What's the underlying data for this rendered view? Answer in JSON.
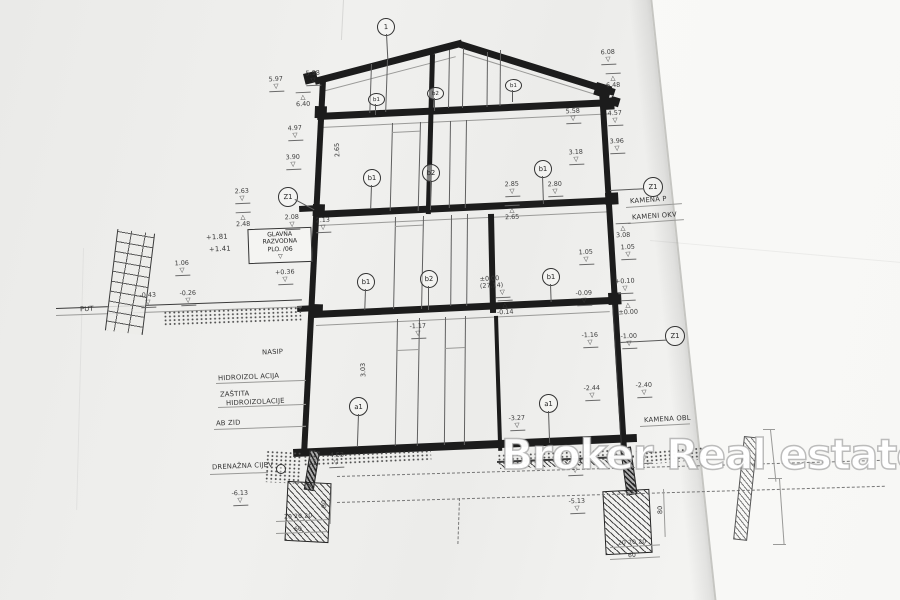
{
  "watermark": {
    "text": "Broker Real estate"
  },
  "markers": {
    "roof_detail": "1",
    "z1_left": "Z1",
    "z1_right": "Z1",
    "z1_lower_right": "Z1",
    "attic": [
      "b1",
      "b2",
      "b1"
    ],
    "level3": [
      "b1",
      "b2",
      "b1"
    ],
    "level2": [
      "b1",
      "b2",
      "b1"
    ],
    "level1": [
      "a1",
      "a1"
    ]
  },
  "labels": {
    "main_panel": {
      "l1": "GLAVNA",
      "l2": "RAZVODNA",
      "l3": "PLO. /06"
    },
    "put": "PUT",
    "nasip": "NASIP",
    "hidroizolacija": "HIDROIZOL ACIJA",
    "zastita_1": "ZAŠTITA",
    "zastita_2": "HIDROIZOLACIJE",
    "ab_zid": "AB ZID",
    "drenazna": "DRENAŽNA CIJEV",
    "kamena_ploca": "KAMENA  P",
    "kameni_okvir": "KAMENI  OKV",
    "kamena_obloga": "KAMENA OBL",
    "lvl_181": "+1.81",
    "lvl_141": "+1.41"
  },
  "elevations": [
    "5.97",
    "5.98",
    "6.40",
    "4.97",
    "3.90",
    "6.08",
    "6.48",
    "5.58",
    "4.57",
    "3.96",
    "3.18",
    "2.85",
    "2.65",
    "2.80",
    "2.63",
    "2.48",
    "2.08",
    "2.13",
    "3.08",
    "1.05",
    "+0.36",
    "1.06",
    "-0.43",
    "-0.26",
    "1.05",
    "±0.00 (27.14)",
    "-0.09",
    "-0.14",
    "+0.10",
    "±0.00",
    "-1.00",
    "-1.17",
    "-1.16",
    "-2.44",
    "-2.40",
    "-3.27",
    "-4.53",
    "4.53",
    "-5.50",
    "-5.13",
    "-6.13"
  ],
  "dims": {
    "level1_height": "3.03",
    "attic_height": "2.65",
    "footing_left_segments": "20 20 20",
    "footing_left_total": "60",
    "footing_right_segments": "20 20 20",
    "footing_right_total": "60",
    "footing_left_depth": "80",
    "footing_right_depth": "80"
  }
}
